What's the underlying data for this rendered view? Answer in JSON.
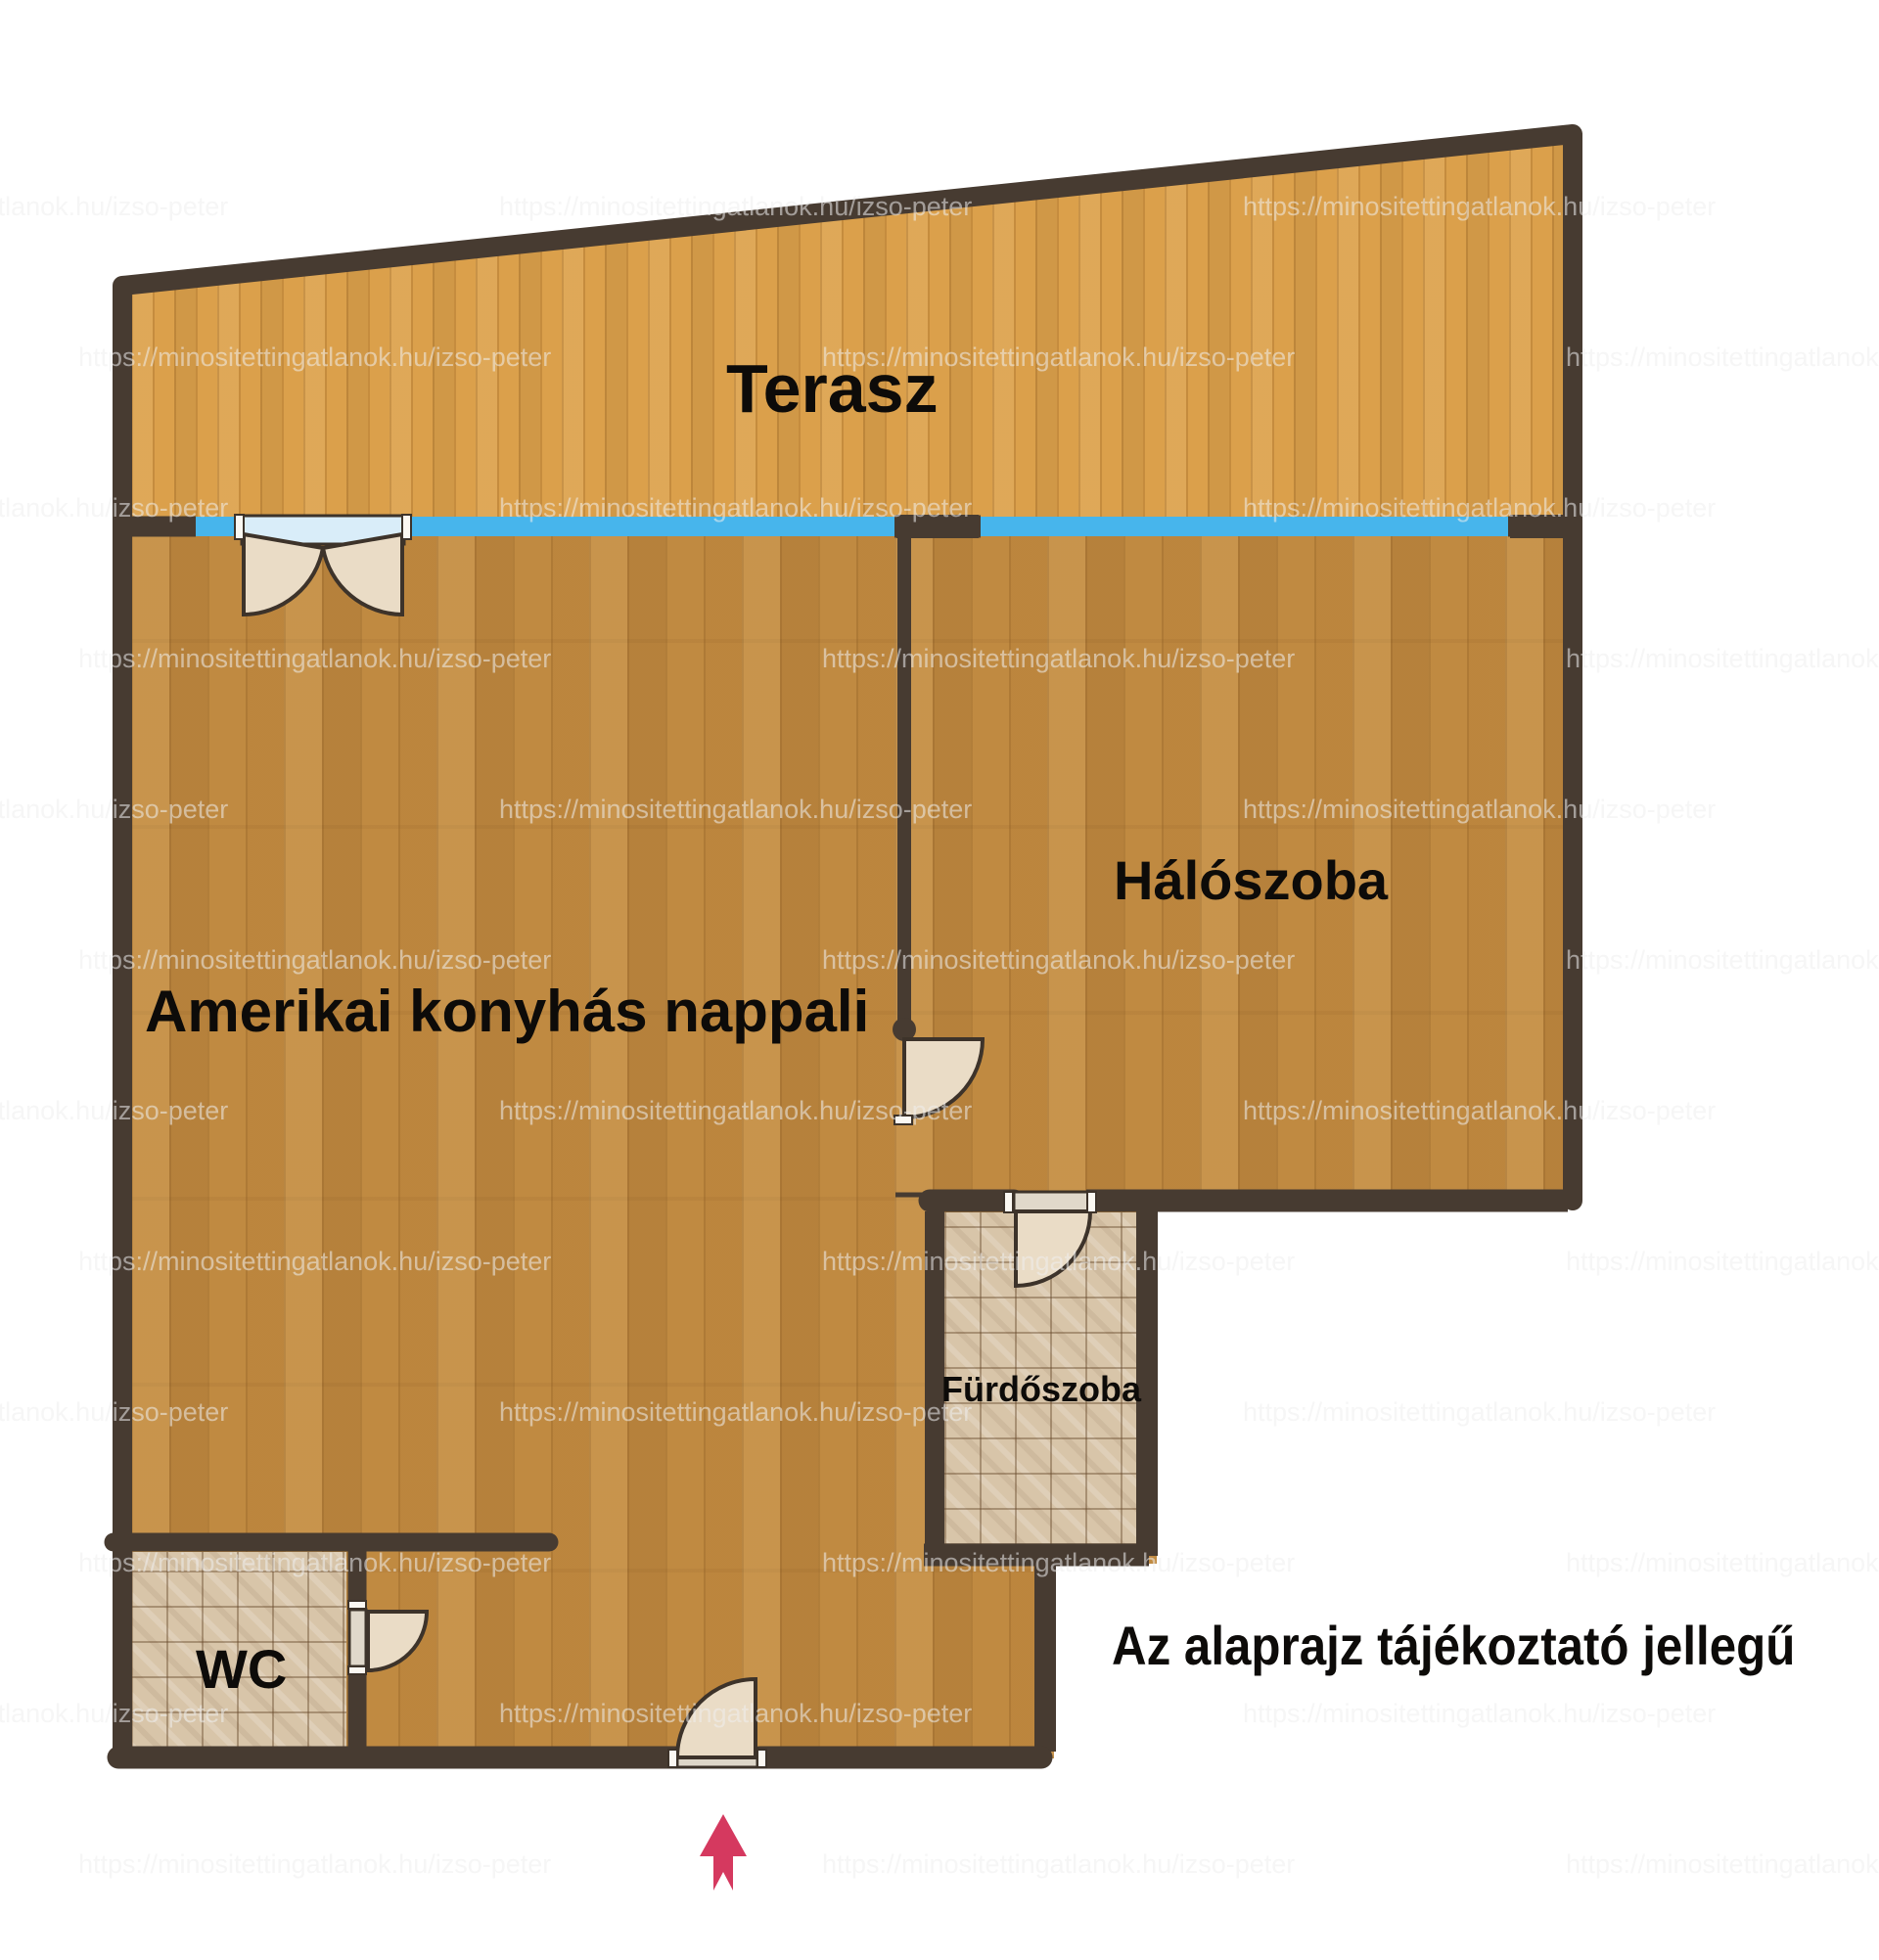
{
  "title": "Lakás alaprajz",
  "rooms": {
    "terrace": {
      "label": "Terasz"
    },
    "living": {
      "label": "Amerikai konyhás nappali"
    },
    "bedroom": {
      "label": "Hálószoba"
    },
    "bathroom": {
      "label": "Fürdőszoba"
    },
    "wc": {
      "label": "WC"
    }
  },
  "note": "Az alaprajz tájékoztató jellegű",
  "watermark": {
    "text": "https://minositettingatlanok.hu/izso-peter"
  },
  "entrance": {
    "symbol": "up-arrow"
  },
  "colors": {
    "wall": "#473b31",
    "window": "#47b5ec",
    "terrace_floor": "#dba04b",
    "interior_floor": "#c08a41",
    "tile_floor": "#d8c5a9",
    "door_leaf": "#eadcc6",
    "door_glass": "#d9edf9",
    "arrow": "#d5395f"
  }
}
